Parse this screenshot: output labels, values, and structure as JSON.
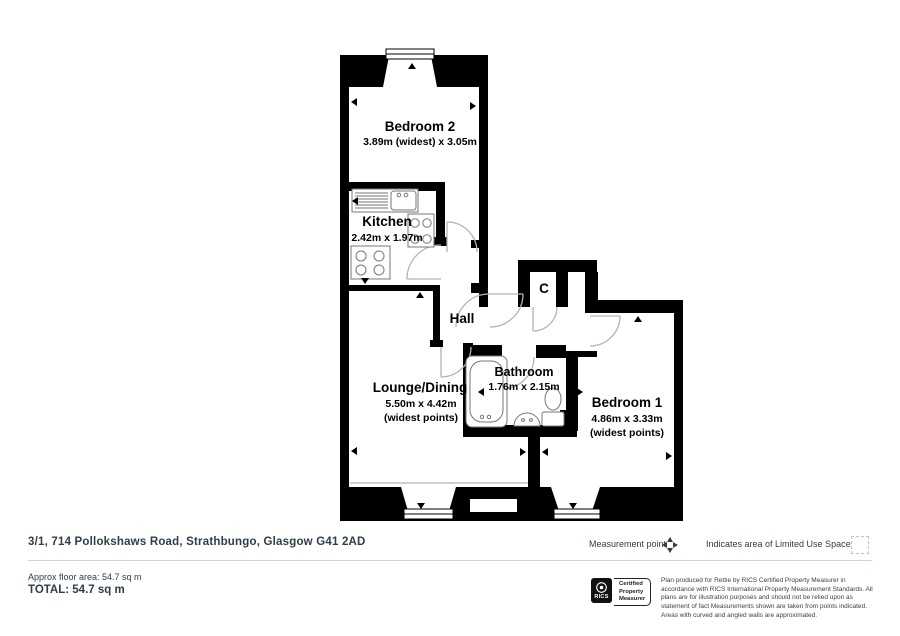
{
  "plan": {
    "rooms": [
      {
        "name": "Bedroom 2",
        "dims": "3.89m (widest) x 3.05m",
        "note": ""
      },
      {
        "name": "Kitchen",
        "dims": "2.42m x 1.97m",
        "note": ""
      },
      {
        "name": "Hall",
        "dims": "",
        "note": ""
      },
      {
        "name": "C",
        "dims": "",
        "note": ""
      },
      {
        "name": "Lounge/Dining",
        "dims": "5.50m x 4.42m",
        "note": "(widest points)"
      },
      {
        "name": "Bathroom",
        "dims": "1.76m x 2.15m",
        "note": ""
      },
      {
        "name": "Bedroom 1",
        "dims": "4.86m x 3.33m",
        "note": "(widest points)"
      }
    ]
  },
  "footer": {
    "address": "3/1, 714 Pollokshaws Road, Strathbungo, Glasgow G41 2AD",
    "approx_area": "Approx floor area: 54.7 sq m",
    "total": "TOTAL: 54.7 sq m",
    "legend": {
      "measurement_point": "Measurement point",
      "limited_use": "Indicates area of  Limited Use Space"
    },
    "rics": {
      "brand": "RICS",
      "certification": [
        "Certified",
        "Property",
        "Measurer"
      ]
    },
    "disclaimer": "Plan produced for Rettie by RICS Certified Property Measurer in accordance with RICS International Property Measurement Standards.  All plans are for illustration purposes and should not be relied upon as statement of fact Measurements shown are taken from points indicated. Areas with curved and angled walls are approximated."
  },
  "colors": {
    "wall": "#000000",
    "door_arc": "#b3b3b3",
    "fixture": "#777777",
    "footer_text": "#2f3e4a",
    "disclaimer_text": "#404040",
    "divider": "#cdd2d6"
  }
}
